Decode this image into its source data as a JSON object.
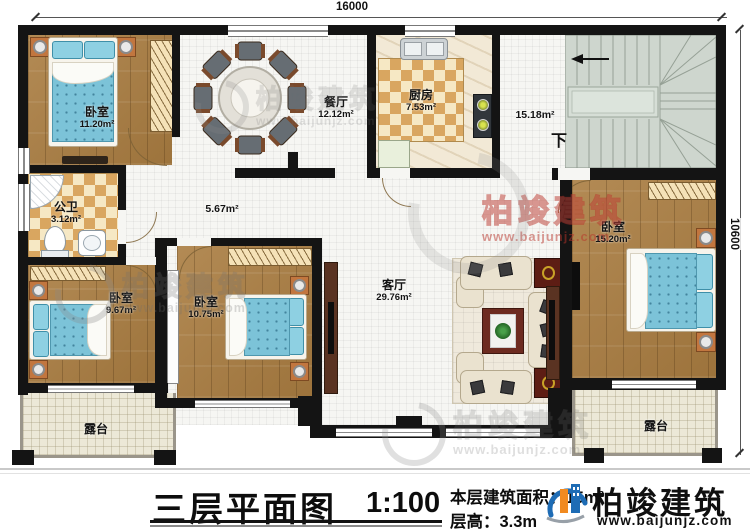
{
  "sheet": {
    "title": "三层平面图",
    "scale": "1:100",
    "area_label": "本层建筑面积：",
    "area_value": "15",
    "area_unit": "m²",
    "floor_height_label": "层高：",
    "floor_height_value": "3.3m"
  },
  "brand": {
    "name": "柏竣建筑",
    "website": "www.baijunjz.com"
  },
  "watermark": {
    "name": "柏竣建筑",
    "website": "www.baijunjz.com"
  },
  "dimensions": {
    "top_width": "16000",
    "right_height": "10600"
  },
  "stairs": {
    "down_label": "下"
  },
  "rooms": [
    {
      "id": "bedroom-top-left",
      "name": "卧室",
      "area": "11.20m²"
    },
    {
      "id": "dining-room",
      "name": "餐厅",
      "area": "12.12m²"
    },
    {
      "id": "kitchen",
      "name": "厨房",
      "area": "7.53m²"
    },
    {
      "id": "stair-hall",
      "name": "",
      "area": "15.18m²"
    },
    {
      "id": "bathroom",
      "name": "公卫",
      "area": "3.12m²"
    },
    {
      "id": "corridor",
      "name": "",
      "area": "5.67m²"
    },
    {
      "id": "bedroom-mid-left",
      "name": "卧室",
      "area": "9.67m²"
    },
    {
      "id": "bedroom-middle",
      "name": "卧室",
      "area": "10.75m²"
    },
    {
      "id": "living-room",
      "name": "客厅",
      "area": "29.76m²"
    },
    {
      "id": "bedroom-right",
      "name": "卧室",
      "area": "15.20m²"
    },
    {
      "id": "terrace-left",
      "name": "露台",
      "area": ""
    },
    {
      "id": "terrace-right",
      "name": "露台",
      "area": ""
    }
  ]
}
